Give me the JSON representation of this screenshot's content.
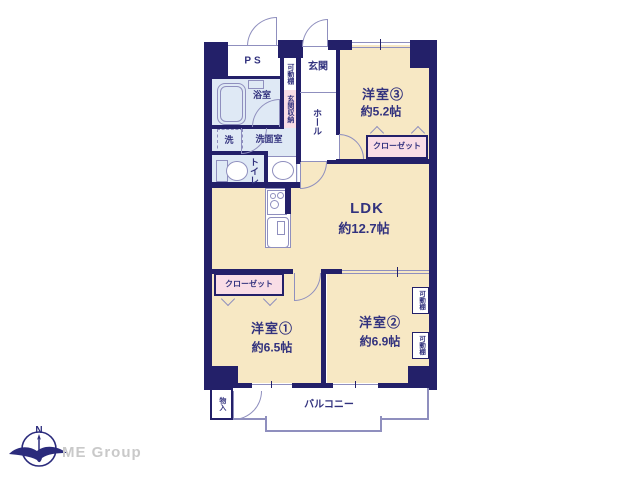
{
  "colors": {
    "wall": "#232069",
    "line": "#8f8fbe",
    "room_cream": "#f7e8c4",
    "wet_blue": "#dfe9f5",
    "closet_pink": "#f9dde6",
    "text": "#32327e",
    "logo_gray": "#c9c9c9",
    "logo_navy": "#2b2b7c"
  },
  "labels": {
    "ps": "PS",
    "genkan": "玄関",
    "hall": "ホール",
    "entry_shelf": "可動棚",
    "entry_storage": "玄関収納",
    "bathroom": "浴室",
    "washer": "洗",
    "washroom": "洗面室",
    "toilet": "トイレ",
    "room3_name": "洋室③",
    "room3_size": "約5.2帖",
    "closet3": "クローゼット",
    "ldk_name": "LDK",
    "ldk_size": "約12.7帖",
    "closet1": "クローゼット",
    "room1_name": "洋室①",
    "room1_size": "約6.5帖",
    "room2_name": "洋室②",
    "room2_size": "約6.9帖",
    "shelf_right_top": "可動棚",
    "shelf_right_bottom": "可動棚",
    "storage_balcony": "物入",
    "balcony": "バルコニー",
    "compass_n": "N",
    "logo_text": "ME Group"
  }
}
